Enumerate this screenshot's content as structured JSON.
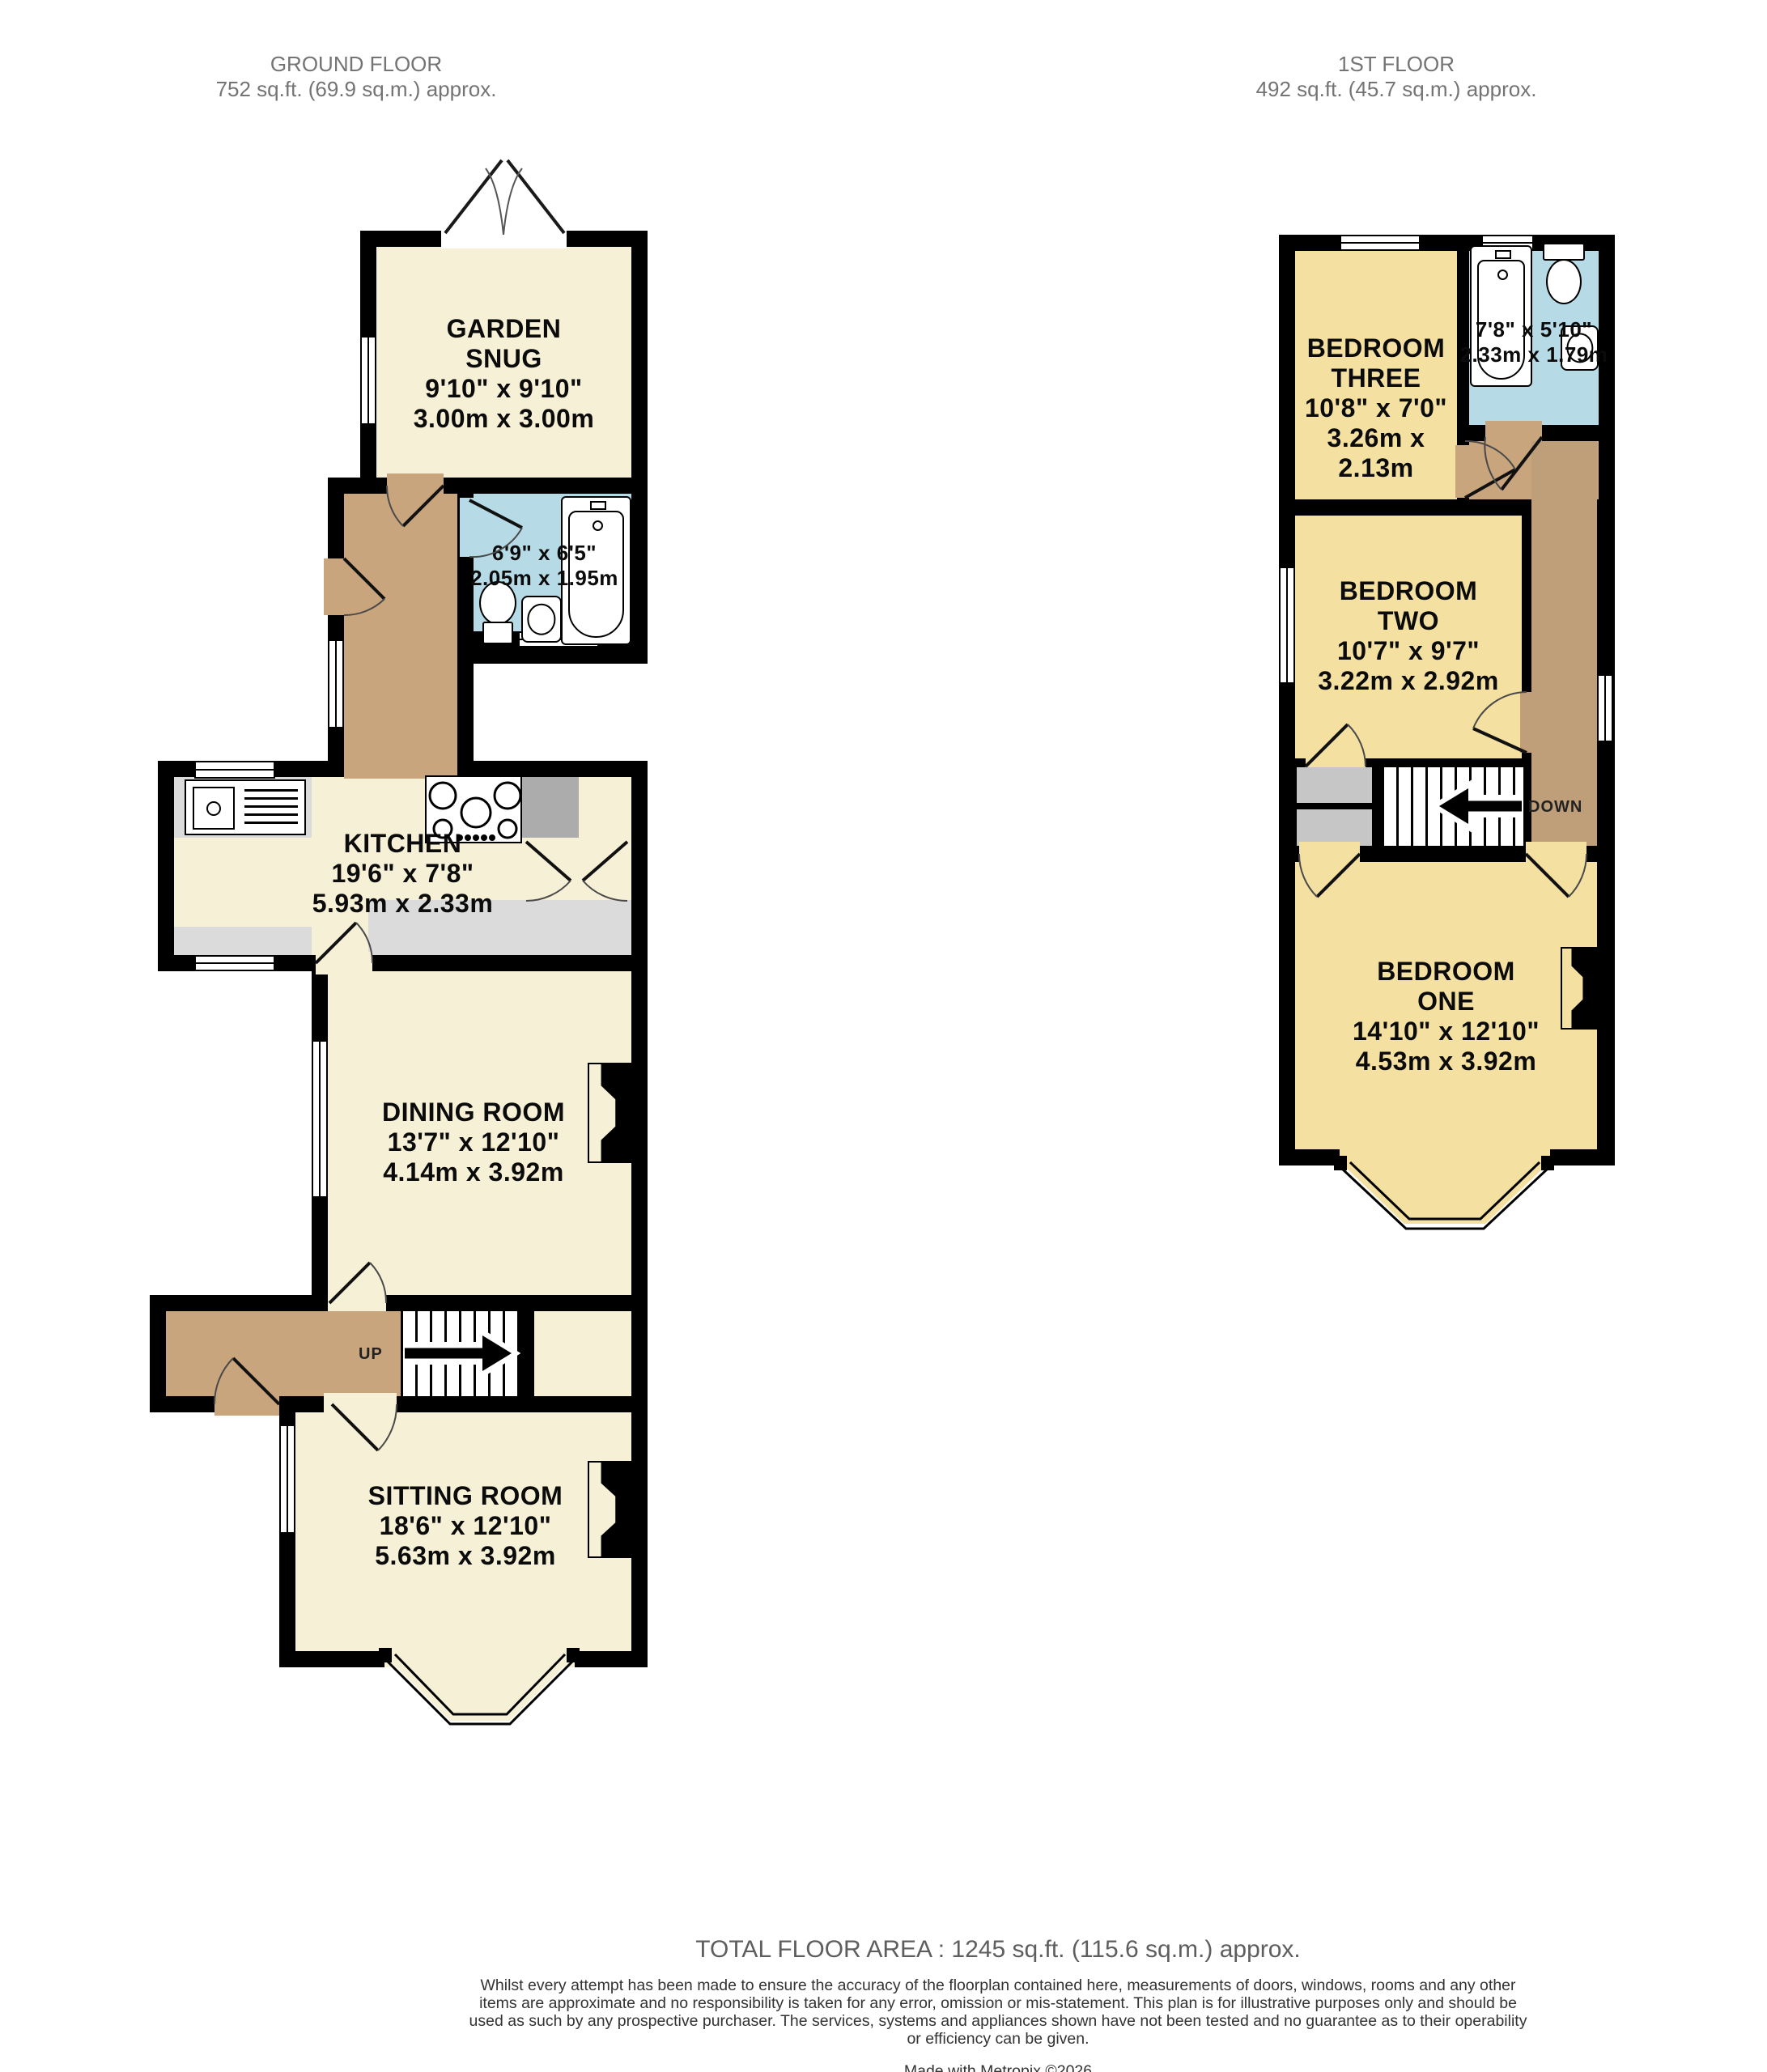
{
  "header": {
    "ground_floor": {
      "title": "GROUND FLOOR",
      "area": "752 sq.ft. (69.9 sq.m.) approx."
    },
    "first_floor": {
      "title": "1ST FLOOR",
      "area": "492 sq.ft. (45.7 sq.m.) approx."
    }
  },
  "ground_floor": {
    "garden_snug": {
      "name1": "GARDEN",
      "name2": "SNUG",
      "imperial": "9'10\" x 9'10\"",
      "metric": "3.00m x 3.00m"
    },
    "bathroom": {
      "name1": "",
      "name2": "",
      "imperial": "6'9\" x 6'5\"",
      "metric": "2.05m x 1.95m"
    },
    "kitchen": {
      "name1": "KITCHEN",
      "name2": "",
      "imperial": "19'6\" x 7'8\"",
      "metric": "5.93m x 2.33m"
    },
    "dining_room": {
      "name1": "DINING ROOM",
      "name2": "",
      "imperial": "13'7\" x 12'10\"",
      "metric": "4.14m x 3.92m"
    },
    "sitting_room": {
      "name1": "SITTING ROOM",
      "name2": "",
      "imperial": "18'6\" x 12'10\"",
      "metric": "5.63m x 3.92m"
    },
    "stairs_label": "UP"
  },
  "first_floor": {
    "bedroom_three": {
      "name1": "BEDROOM",
      "name2": "THREE",
      "imperial": "10'8\" x 7'0\"",
      "metric": "3.26m x 2.13m"
    },
    "bathroom": {
      "name1": "",
      "name2": "",
      "imperial": "7'8\" x 5'10\"",
      "metric": "2.33m x 1.79m"
    },
    "bedroom_two": {
      "name1": "BEDROOM",
      "name2": "TWO",
      "imperial": "10'7\" x 9'7\"",
      "metric": "3.22m x 2.92m"
    },
    "bedroom_one": {
      "name1": "BEDROOM",
      "name2": "ONE",
      "imperial": "14'10\" x 12'10\"",
      "metric": "4.53m x 3.92m"
    },
    "stairs_label": "DOWN"
  },
  "footer": {
    "total_area": "TOTAL FLOOR AREA : 1245 sq.ft. (115.6 sq.m.) approx.",
    "disclaimer": "Whilst every attempt has been made to ensure the accuracy of the floorplan contained here, measurements of doors, windows, rooms and any other items are approximate and no responsibility is taken for any error, omission or mis-statement. This plan is for illustrative purposes only and should be used as such by any prospective purchaser. The services, systems and appliances shown have not been tested and no guarantee as to their operability or efficiency can be given.",
    "credit": "Made with Metropix ©2026"
  },
  "colors": {
    "wall": "#000000",
    "ground_room": "#F6F0D6",
    "bedroom": "#F4E1A2",
    "bathroom": "#B6DBE7",
    "hall": "#C8A57D",
    "counter": "#DBDBDB"
  }
}
